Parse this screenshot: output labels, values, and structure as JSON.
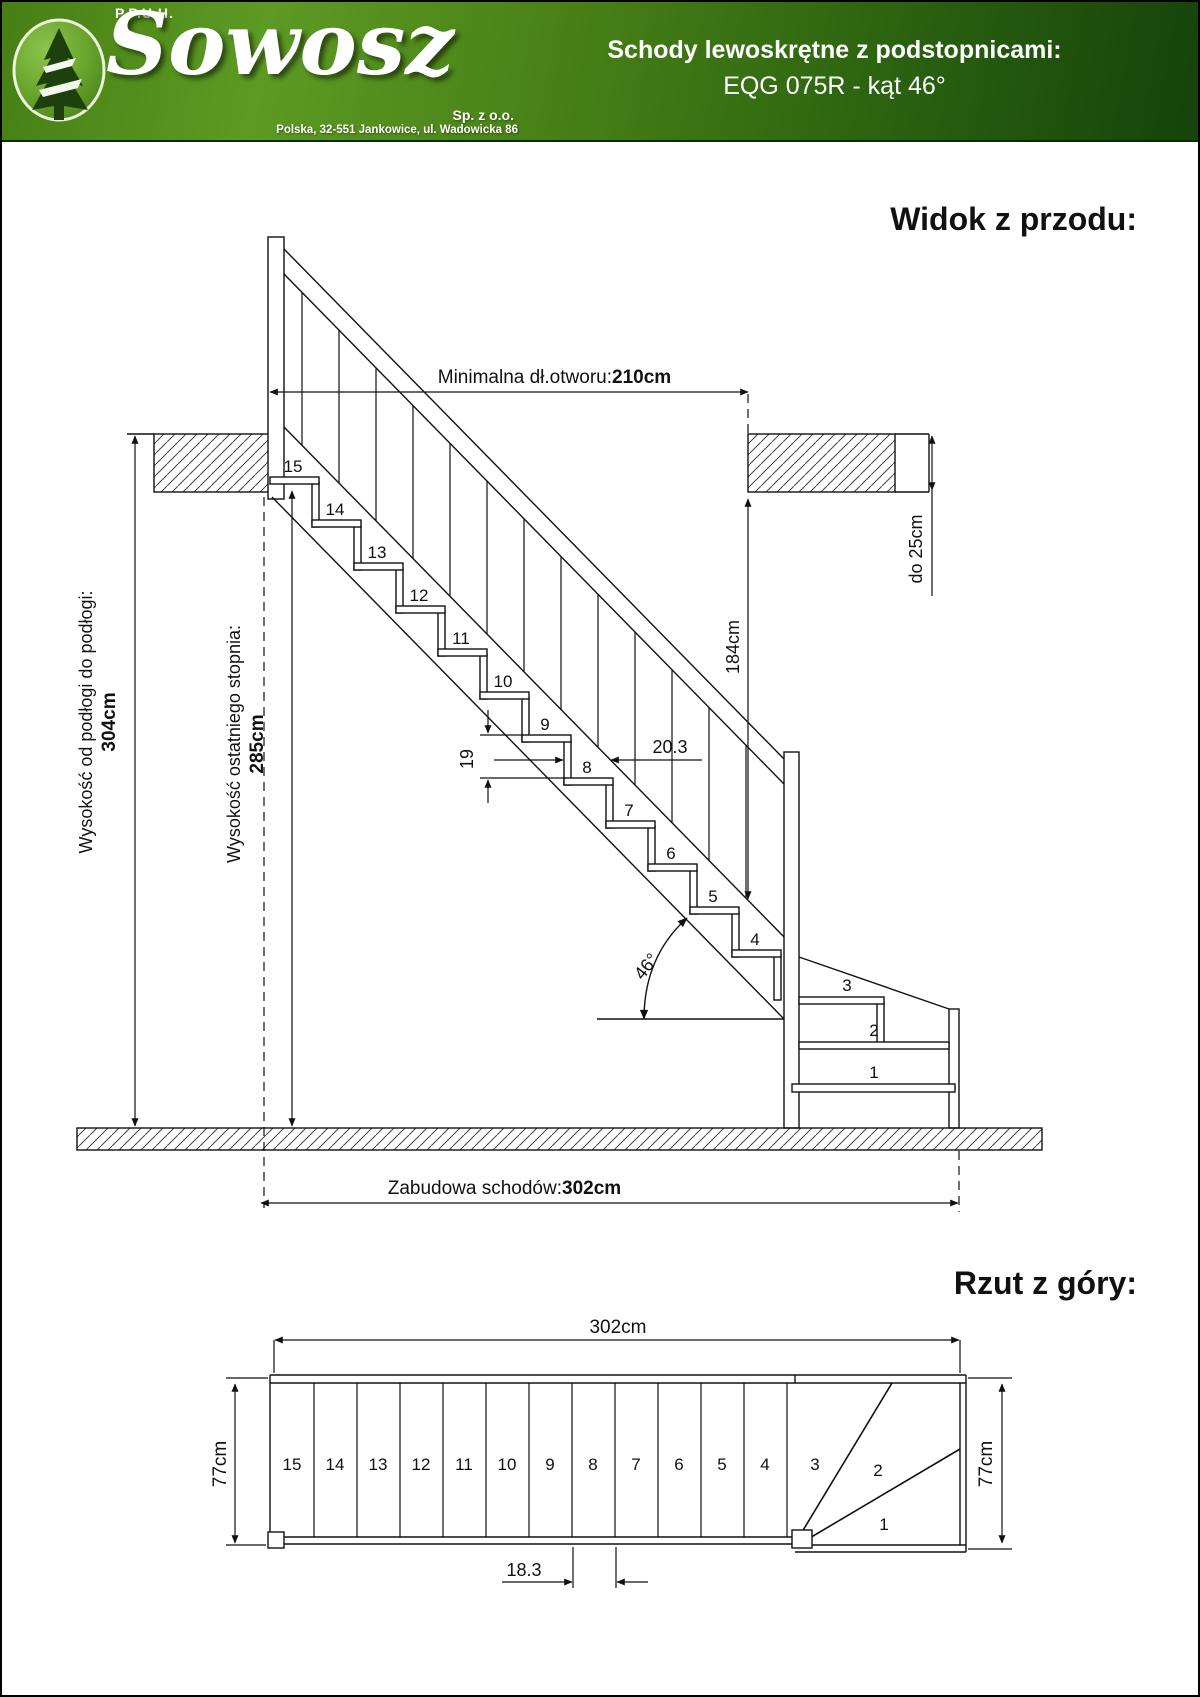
{
  "header": {
    "company_prefix": "P.P.U.H.",
    "company_name": "Sowosz",
    "company_type": "Sp. z o.o.",
    "company_address": "Polska, 32-551 Jankowice, ul. Wadowicka 86",
    "product_title_line1": "Schody lewoskrętne z podstopnicami:",
    "product_title_line2": "EQG 075R - kąt 46°",
    "logo_icon": "pine-tree-icon",
    "colors": {
      "header_green_light": "#5d9a23",
      "header_green_dark": "#15430a",
      "logo_circle_green": "#68a32c",
      "tree_dark_green": "#1d400c"
    }
  },
  "front_view": {
    "heading": "Widok z przodu:",
    "step_numbers": [
      "15",
      "14",
      "13",
      "12",
      "11",
      "10",
      "9",
      "8",
      "7",
      "6",
      "5",
      "4",
      "3",
      "2",
      "1"
    ],
    "dimensions": {
      "opening_label": "Minimalna dł.otworu: ",
      "opening_value": "210cm",
      "floor_to_floor_label": "Wysokość od podłogi do podłogi:",
      "floor_to_floor_value": "304cm",
      "last_step_label": "Wysokość ostatniego stopnia:",
      "last_step_value": "285cm",
      "headroom_value": "184cm",
      "ceiling_thickness_value": "do 25cm",
      "riser_height_value": "19",
      "tread_depth_value": "20.3",
      "angle_value": "46°",
      "footprint_label": "Zabudowa schodów: ",
      "footprint_value": "302cm"
    }
  },
  "plan_view": {
    "heading": "Rzut z góry:",
    "step_numbers": [
      "15",
      "14",
      "13",
      "12",
      "11",
      "10",
      "9",
      "8",
      "7",
      "6",
      "5",
      "4",
      "3",
      "2",
      "1"
    ],
    "dimensions": {
      "length_value": "302cm",
      "width_left_value": "77cm",
      "width_right_value": "77cm",
      "tread_spacing_value": "18.3"
    }
  }
}
